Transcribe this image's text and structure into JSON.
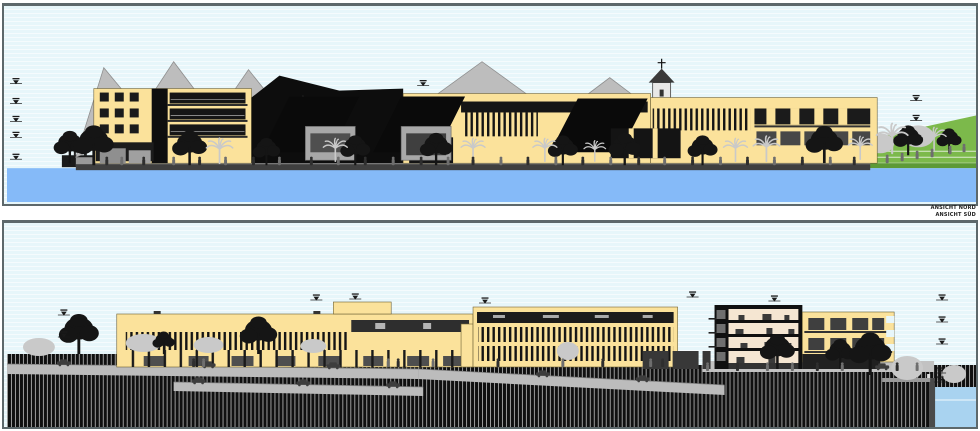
{
  "document": {
    "type": "architectural-elevation-sheet"
  },
  "panels": [
    {
      "id": "north",
      "label": "ANSICHT NORD"
    },
    {
      "id": "south",
      "label": "ANSICHT SÜD"
    }
  ],
  "colors": {
    "border": "#5d686b",
    "label": "#222222",
    "sky": "#e7f6fa",
    "skyStripe": "#f5fbfd",
    "waterNorth": "#85baf8",
    "waterSouth": "#a9d3f0",
    "waterSouthLine": "#cde6f6",
    "facade": "#fbe29b",
    "facadeEdge": "#8a7a42",
    "roofDark": "#0d0d0d",
    "windowDark": "#1b1b1b",
    "windowGray": "#474747",
    "gable": "#bdbdbd",
    "gableEdge": "#8f8f8f",
    "hill": "#7cb94b",
    "hillDark": "#5d9a36",
    "hillLine": "#dcead2",
    "deck": "#9a9a9a",
    "deckEdge": "#3f3f3f",
    "road": "#bcbcbc",
    "roadEdge": "#7d7d7d",
    "hatchDark": "#101010",
    "hatchLight": "#9b9b9b",
    "interior": "#f5e6d2",
    "pavilion": "#a8a8a8",
    "treeDark": "#151515",
    "treeLight": "#c9c9c9",
    "figure": "#6e6e6e",
    "figureDark": "#2e2e2e",
    "church": "#e8e8e8"
  }
}
